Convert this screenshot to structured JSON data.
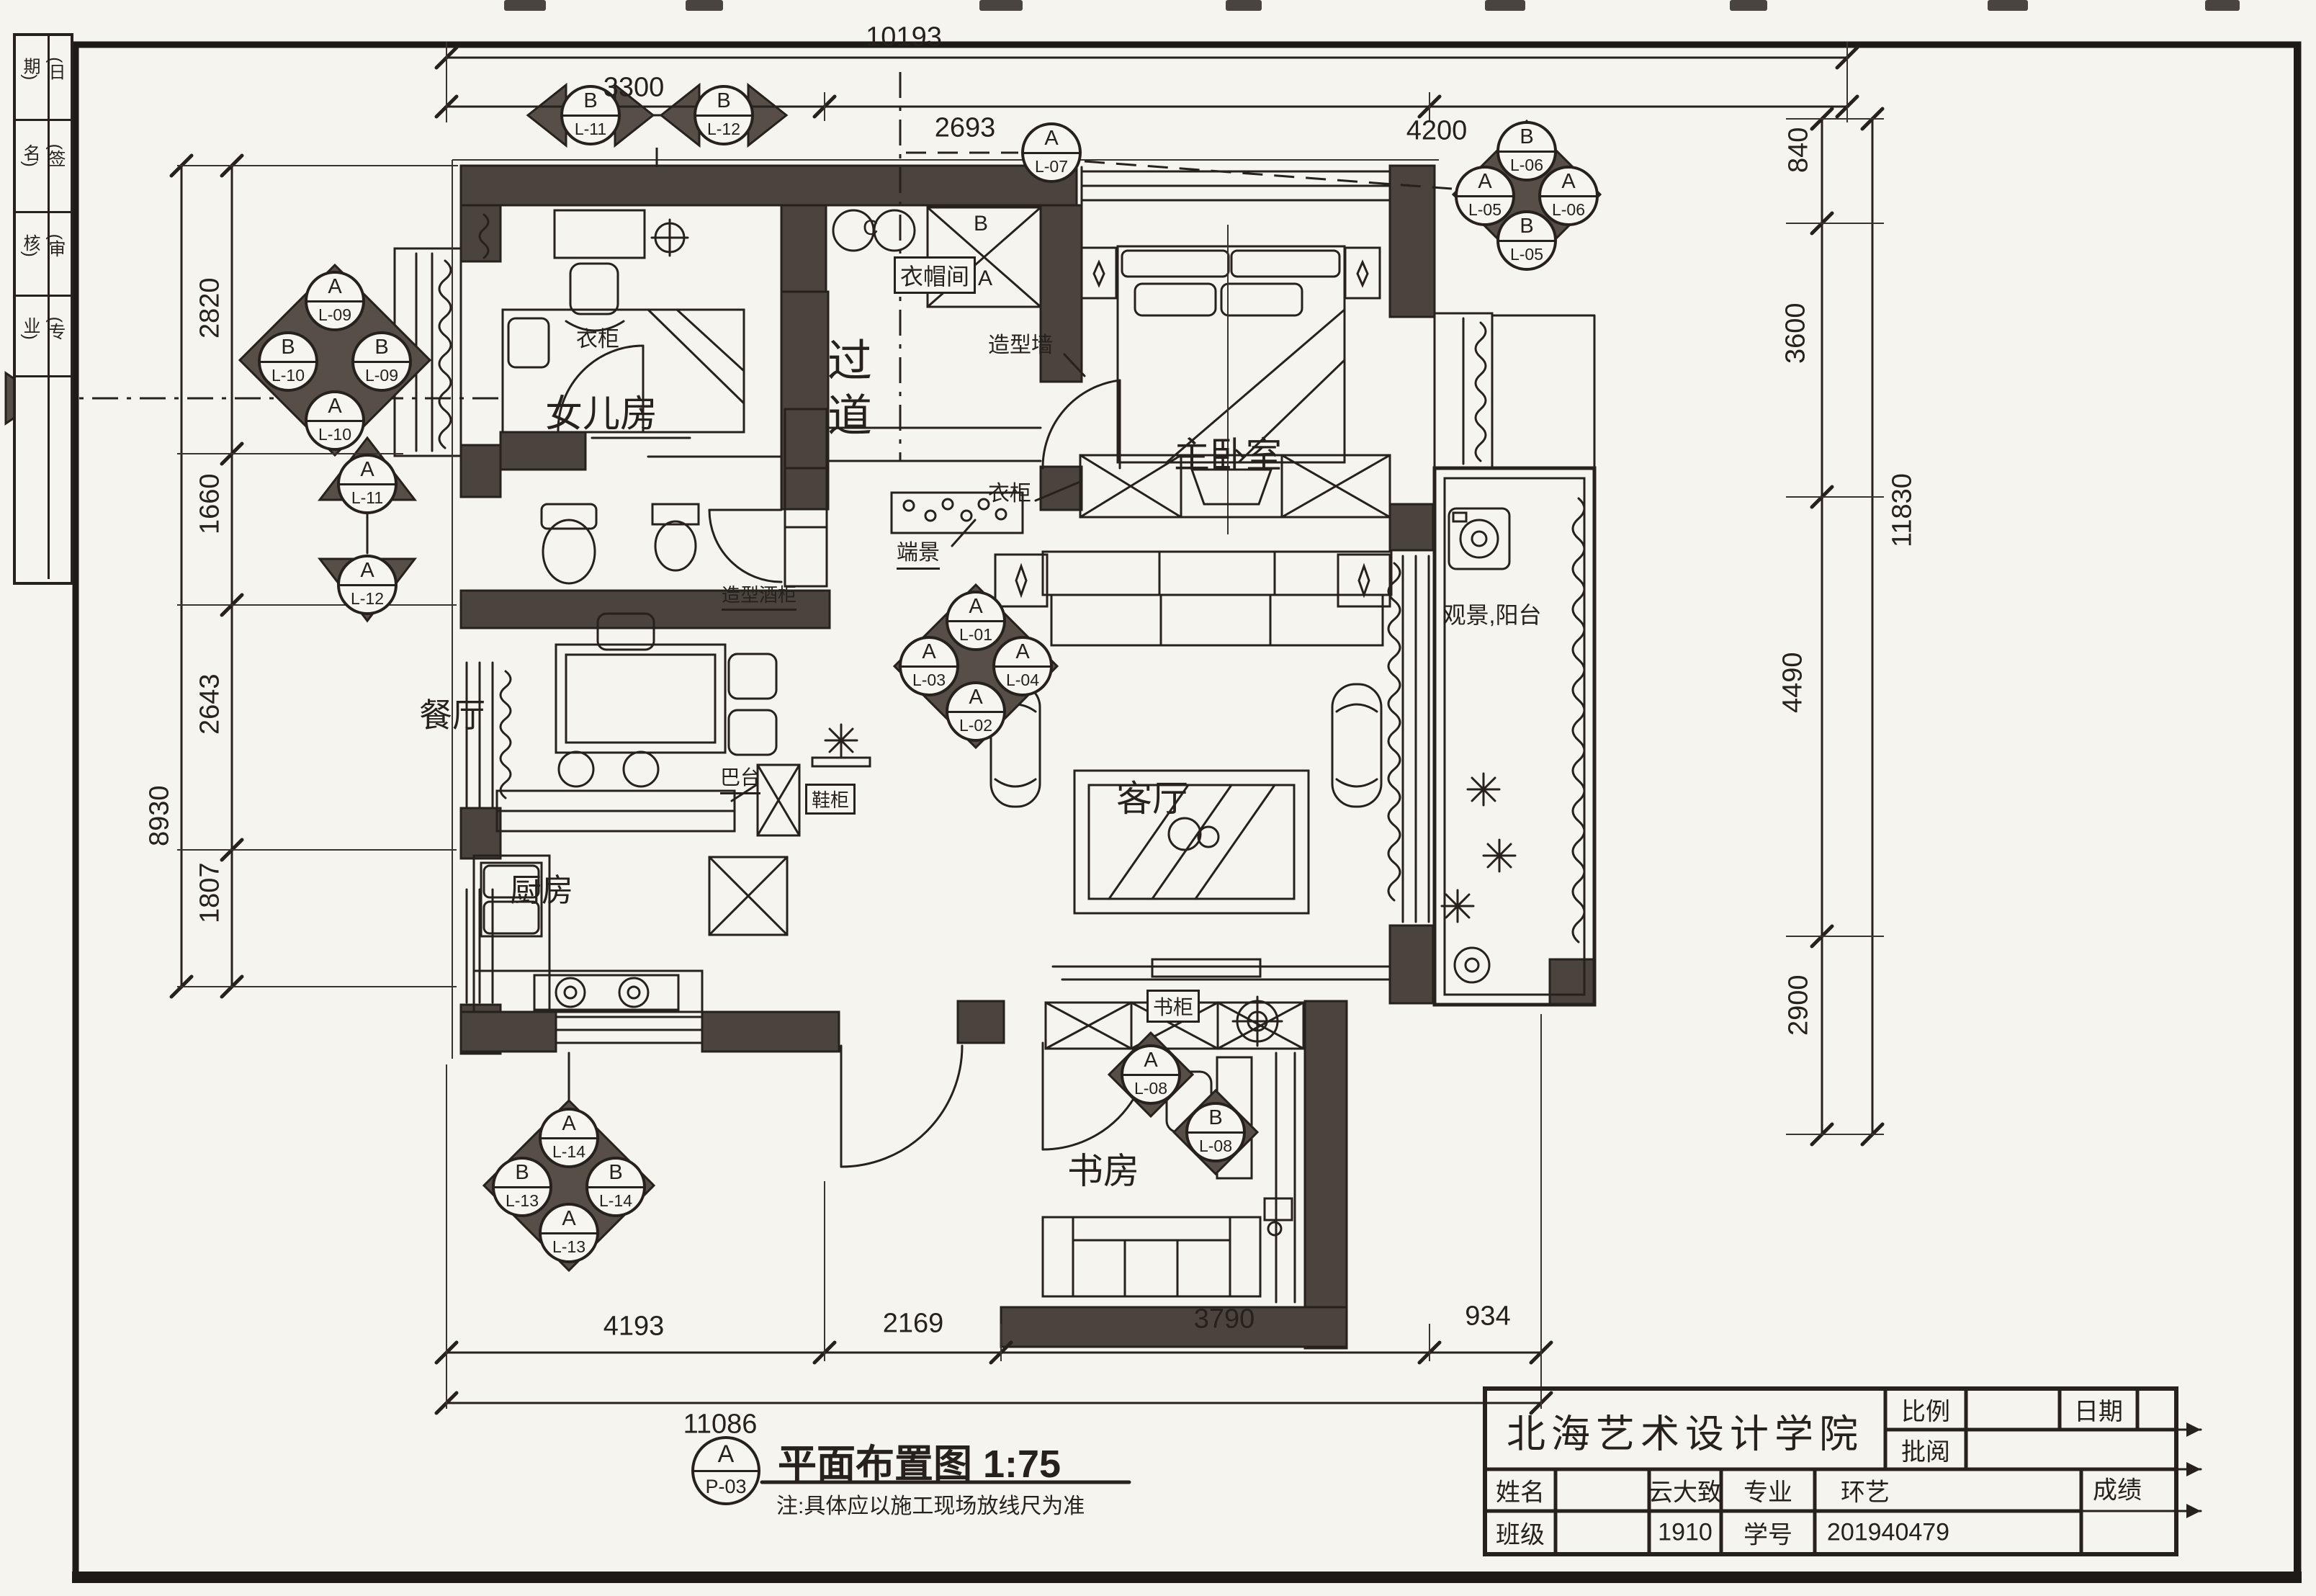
{
  "sheet": {
    "side_strip": {
      "items": [
        "(日期)",
        "(签名)",
        "(审核)",
        "(专业)"
      ]
    },
    "caption": {
      "bubble_top": "A",
      "bubble_bottom": "P-03",
      "title": "平面布置图 1:75",
      "note": "注:具体应以施工现场放线尺为准"
    },
    "title_block": {
      "school": "北海艺术设计学院",
      "scale_label": "比例",
      "date_label": "日期",
      "review_label": "批阅",
      "name_label": "姓名",
      "name_value": "云大致",
      "major_label": "专业",
      "major_value": "环艺",
      "class_label": "班级",
      "class_value": "1910",
      "sid_label": "学号",
      "sid_value": "201940479",
      "grade_label": "成绩"
    }
  },
  "rooms": {
    "daughter": "女儿房",
    "cloakroom": "衣帽间",
    "master": "主卧室",
    "corridor": "过道",
    "dining": "餐厅",
    "living": "客厅",
    "kitchen": "厨房",
    "study": "书房",
    "balcony": "观景,阳台"
  },
  "labels": {
    "wardrobe_daughter": "衣柜",
    "wardrobe_master": "衣柜",
    "feature_wall": "造型墙",
    "end_view": "端景",
    "wine_cabinet": "造型酒柜",
    "bar_counter": "巴台",
    "shoe_cabinet": "鞋柜",
    "bookcase": "书柜",
    "letter_c": "C",
    "letter_b": "B",
    "letter_a": "A"
  },
  "dims": {
    "top": {
      "overall": "10193",
      "segments": [
        "3300",
        "2693",
        "4200"
      ]
    },
    "left": {
      "overall": "8930",
      "segments": [
        "2820",
        "1660",
        "2643",
        "1807"
      ]
    },
    "right": {
      "overall": "11830",
      "segments": [
        "840",
        "3600",
        "4490",
        "2900"
      ]
    },
    "bottom": {
      "overall": "11086",
      "segments": [
        "4193",
        "2169",
        "3790",
        "934"
      ]
    }
  },
  "markers": {
    "top_pair": [
      {
        "t": "B",
        "b": "L-11"
      },
      {
        "t": "B",
        "b": "L-12"
      }
    ],
    "left_cluster": [
      {
        "t": "A",
        "b": "L-09"
      },
      {
        "t": "B",
        "b": "L-10"
      },
      {
        "t": "B",
        "b": "L-09"
      },
      {
        "t": "A",
        "b": "L-10"
      }
    ],
    "left_tris": [
      {
        "t": "A",
        "b": "L-11"
      },
      {
        "t": "A",
        "b": "L-12"
      }
    ],
    "solo": {
      "t": "A",
      "b": "L-07"
    },
    "right_cluster": [
      {
        "t": "B",
        "b": "L-06"
      },
      {
        "t": "A",
        "b": "L-05"
      },
      {
        "t": "A",
        "b": "L-06"
      },
      {
        "t": "B",
        "b": "L-05"
      }
    ],
    "center_cluster": [
      {
        "t": "A",
        "b": "L-01"
      },
      {
        "t": "A",
        "b": "L-03"
      },
      {
        "t": "A",
        "b": "L-04"
      },
      {
        "t": "A",
        "b": "L-02"
      }
    ],
    "bottom_cluster": [
      {
        "t": "A",
        "b": "L-14"
      },
      {
        "t": "B",
        "b": "L-13"
      },
      {
        "t": "B",
        "b": "L-14"
      },
      {
        "t": "A",
        "b": "L-13"
      }
    ],
    "study_pair": [
      {
        "t": "A",
        "b": "L-08"
      },
      {
        "t": "B",
        "b": "L-08"
      }
    ]
  },
  "colors": {
    "ink": "#26211d",
    "wall": "#4b433d",
    "paper": "#f6f4ee"
  }
}
